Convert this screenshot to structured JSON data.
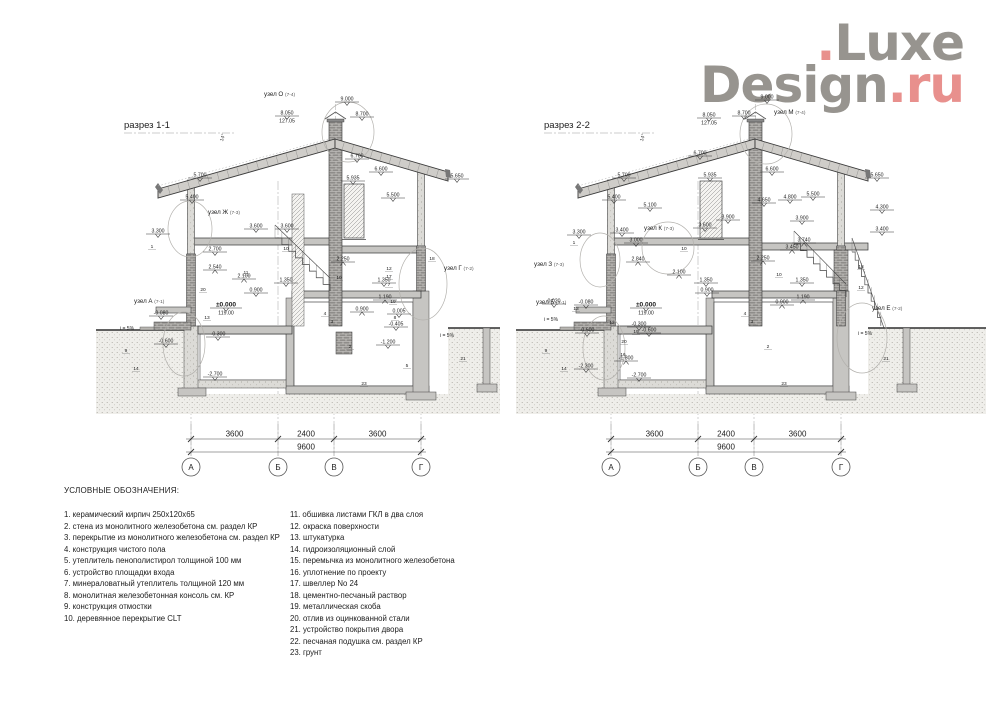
{
  "logo": {
    "top_dot": ".",
    "top_text": "Luxe",
    "bottom_text": "Design",
    "suffix": ".ru",
    "gray_color": "#97948f",
    "red_color": "#e8908d"
  },
  "legend": {
    "title": "УСЛОВНЫЕ ОБОЗНАЧЕНИЯ:",
    "col1": [
      "1. керамический кирпич 250x120x65",
      "2. стена из монолитного железобетона см. раздел КР",
      "3. перекрытие из монолитного железобетона см. раздел КР",
      "4. конструкция чистого пола",
      "5. утеплитель пенополистирол толщиной 100 мм",
      "6. устройство площадки входа",
      "7. минераловатный утеплитель толщиной 120 мм",
      "8. монолитная железобетонная консоль см. КР",
      "9. конструкция отмостки",
      "10. деревянное перекрытие CLT"
    ],
    "col2": [
      "11. обшивка листами ГКЛ в два слоя",
      "12. окраска поверхности",
      "13. штукатурка",
      "14. гидроизоляционный слой",
      "15. перемычка из монолитного железобетона",
      "16. уплотнение по проекту",
      "17. швеллер No 24",
      "18. цементно-песчаный раствор",
      "19. металлическая скоба",
      "20. отлив из оцинкованной стали",
      "21. устройство покрытия двора",
      "22. песчаная подушка см. раздел КР",
      "23. грунт"
    ]
  },
  "dimensions": {
    "segments": [
      "3600",
      "2400",
      "3600"
    ],
    "total": "9600",
    "axes": [
      "А",
      "Б",
      "В",
      "Г"
    ]
  },
  "sections": [
    {
      "id": "1-1",
      "title": "разрез 1-1",
      "angle": "14°",
      "nodes": [
        {
          "label": "узел О",
          "ref": "(7-4)",
          "x": 168,
          "y": 10,
          "cx": 252,
          "cy": 46,
          "rx": 26,
          "ry": 30
        },
        {
          "label": "узел Ж",
          "ref": "(7-3)",
          "x": 112,
          "y": 128,
          "cx": 94,
          "cy": 143,
          "rx": 22,
          "ry": 28
        },
        {
          "label": "узел Г",
          "ref": "(7-2)",
          "x": 348,
          "y": 184,
          "cx": 327,
          "cy": 198,
          "rx": 24,
          "ry": 36
        },
        {
          "label": "узел А",
          "ref": "(7-1)",
          "x": 38,
          "y": 217,
          "cx": 88,
          "cy": 258,
          "rx": 21,
          "ry": 32
        }
      ],
      "marks": [
        {
          "t": "9.000",
          "x": 251,
          "y": 16
        },
        {
          "t": "8.700",
          "x": 266,
          "y": 31
        },
        {
          "t": "8.050",
          "sub": "127.05",
          "x": 191,
          "y": 30
        },
        {
          "t": "6.700",
          "x": 261,
          "y": 73
        },
        {
          "t": "6.600",
          "x": 285,
          "y": 86
        },
        {
          "t": "5.935",
          "x": 257,
          "y": 95
        },
        {
          "t": "5.700",
          "x": 104,
          "y": 92
        },
        {
          "t": "5.400",
          "x": 96,
          "y": 114
        },
        {
          "t": "5.650",
          "x": 361,
          "y": 93
        },
        {
          "t": "5.500",
          "x": 297,
          "y": 112
        },
        {
          "t": "3.600",
          "x": 160,
          "y": 143
        },
        {
          "t": "3.600",
          "x": 191,
          "y": 143
        },
        {
          "t": "3.300",
          "x": 62,
          "y": 148
        },
        {
          "t": "2.700",
          "x": 119,
          "y": 166
        },
        {
          "t": "2.540",
          "x": 119,
          "y": 184,
          "up": 1
        },
        {
          "t": "2.250",
          "x": 247,
          "y": 176,
          "up": 1
        },
        {
          "t": "2.100",
          "x": 148,
          "y": 193,
          "up": 1
        },
        {
          "t": "1.350",
          "x": 190,
          "y": 197
        },
        {
          "t": "1.350",
          "x": 288,
          "y": 197
        },
        {
          "t": "1.190",
          "x": 289,
          "y": 214,
          "up": 1
        },
        {
          "t": "0.900",
          "x": 160,
          "y": 207
        },
        {
          "t": "0.900",
          "x": 266,
          "y": 226,
          "up": 1
        },
        {
          "t": "0.005",
          "x": 303,
          "y": 228
        },
        {
          "t": "-0.405",
          "x": 300,
          "y": 241
        },
        {
          "t": "-0.080",
          "x": 65,
          "y": 230
        },
        {
          "t": "-0.600",
          "x": 70,
          "y": 258
        },
        {
          "t": "-0.300",
          "x": 122,
          "y": 251
        },
        {
          "t": "-1.200",
          "x": 292,
          "y": 259
        },
        {
          "t": "-2.700",
          "x": 119,
          "y": 291
        },
        {
          "t": "±0.000",
          "sub": "119.00",
          "x": 130,
          "y": 222,
          "big": 1
        }
      ],
      "callouts": [
        {
          "t": "1",
          "x": 56,
          "y": 162
        },
        {
          "t": "20",
          "x": 107,
          "y": 205
        },
        {
          "t": "13",
          "x": 111,
          "y": 233
        },
        {
          "t": "9",
          "x": 30,
          "y": 266
        },
        {
          "t": "14",
          "x": 40,
          "y": 284
        },
        {
          "t": "10",
          "x": 190,
          "y": 164
        },
        {
          "t": "10",
          "x": 243,
          "y": 193
        },
        {
          "t": "11",
          "x": 150,
          "y": 188
        },
        {
          "t": "2",
          "x": 254,
          "y": 262
        },
        {
          "t": "4",
          "x": 229,
          "y": 229
        },
        {
          "t": "3",
          "x": 236,
          "y": 237
        },
        {
          "t": "12",
          "x": 293,
          "y": 184
        },
        {
          "t": "17",
          "x": 293,
          "y": 192
        },
        {
          "t": "7",
          "x": 293,
          "y": 200
        },
        {
          "t": "19",
          "x": 297,
          "y": 217
        },
        {
          "t": "8",
          "x": 299,
          "y": 233
        },
        {
          "t": "18",
          "x": 336,
          "y": 174
        },
        {
          "t": "21",
          "x": 367,
          "y": 274
        },
        {
          "t": "23",
          "x": 268,
          "y": 299
        },
        {
          "t": "5",
          "x": 311,
          "y": 281
        }
      ],
      "slopes": [
        {
          "t": "i = 5%",
          "x": 24,
          "y": 244
        },
        {
          "t": "i = 5%",
          "x": 344,
          "y": 251
        }
      ]
    },
    {
      "id": "2-2",
      "title": "разрез 2-2",
      "angle": "14°",
      "nodes": [
        {
          "label": "узел М",
          "ref": "(7-4)",
          "x": 258,
          "y": 28,
          "cx": 250,
          "cy": 48,
          "rx": 26,
          "ry": 30
        },
        {
          "label": "узел К",
          "ref": "(7-3)",
          "x": 128,
          "y": 144,
          "cx": 152,
          "cy": 162,
          "rx": 26,
          "ry": 26
        },
        {
          "label": "узел З",
          "ref": "(7-3)",
          "x": 18,
          "y": 180,
          "cx": 84,
          "cy": 174,
          "rx": 20,
          "ry": 27
        },
        {
          "label": "узел Б",
          "ref": "(7-1)",
          "x": 20,
          "y": 218,
          "cx": 88,
          "cy": 262,
          "rx": 21,
          "ry": 32
        },
        {
          "label": "узел Е",
          "ref": "(7-2)",
          "x": 356,
          "y": 224,
          "cx": 346,
          "cy": 252,
          "rx": 25,
          "ry": 35
        }
      ],
      "marks": [
        {
          "t": "9.000",
          "x": 251,
          "y": 14
        },
        {
          "t": "8.700",
          "x": 228,
          "y": 30
        },
        {
          "t": "8.050",
          "sub": "127.05",
          "x": 193,
          "y": 32
        },
        {
          "t": "6.700",
          "x": 184,
          "y": 70
        },
        {
          "t": "6.600",
          "x": 256,
          "y": 86
        },
        {
          "t": "5.935",
          "x": 194,
          "y": 92
        },
        {
          "t": "5.700",
          "x": 108,
          "y": 92
        },
        {
          "t": "5.400",
          "x": 98,
          "y": 114
        },
        {
          "t": "5.100",
          "x": 134,
          "y": 122
        },
        {
          "t": "5.650",
          "x": 361,
          "y": 92
        },
        {
          "t": "5.500",
          "x": 297,
          "y": 111
        },
        {
          "t": "4.800",
          "x": 274,
          "y": 114
        },
        {
          "t": "4.650",
          "x": 248,
          "y": 117
        },
        {
          "t": "4.300",
          "x": 366,
          "y": 124
        },
        {
          "t": "3.900",
          "x": 212,
          "y": 134
        },
        {
          "t": "3.900",
          "x": 286,
          "y": 135
        },
        {
          "t": "3.740",
          "x": 288,
          "y": 157,
          "up": 1
        },
        {
          "t": "3.450",
          "x": 276,
          "y": 164,
          "up": 1
        },
        {
          "t": "3.600",
          "x": 189,
          "y": 142
        },
        {
          "t": "3.400",
          "x": 106,
          "y": 147
        },
        {
          "t": "3.400",
          "x": 366,
          "y": 146
        },
        {
          "t": "3.300",
          "x": 63,
          "y": 149
        },
        {
          "t": "3.000",
          "x": 120,
          "y": 157
        },
        {
          "t": "2.840",
          "x": 122,
          "y": 176,
          "up": 1
        },
        {
          "t": "2.250",
          "x": 247,
          "y": 175,
          "up": 1
        },
        {
          "t": "2.100",
          "x": 163,
          "y": 189,
          "up": 1
        },
        {
          "t": "1.350",
          "x": 190,
          "y": 197
        },
        {
          "t": "1.350",
          "x": 286,
          "y": 197
        },
        {
          "t": "1.190",
          "x": 287,
          "y": 214,
          "up": 1
        },
        {
          "t": "0.900",
          "x": 191,
          "y": 207
        },
        {
          "t": "0.900",
          "x": 266,
          "y": 219,
          "up": 1
        },
        {
          "t": "0.020",
          "x": 38,
          "y": 218
        },
        {
          "t": "-0.080",
          "x": 70,
          "y": 219
        },
        {
          "t": "-0.300",
          "x": 123,
          "y": 241
        },
        {
          "t": "-0.600",
          "x": 71,
          "y": 247
        },
        {
          "t": "-0.600",
          "x": 133,
          "y": 247
        },
        {
          "t": "-1.800",
          "x": 110,
          "y": 275,
          "up": 1
        },
        {
          "t": "-2.300",
          "x": 70,
          "y": 283
        },
        {
          "t": "-2.700",
          "x": 123,
          "y": 292
        },
        {
          "t": "±0.000",
          "sub": "119.00",
          "x": 130,
          "y": 222,
          "big": 1
        }
      ],
      "callouts": [
        {
          "t": "1",
          "x": 58,
          "y": 158
        },
        {
          "t": "12",
          "x": 96,
          "y": 238
        },
        {
          "t": "10",
          "x": 168,
          "y": 164
        },
        {
          "t": "10",
          "x": 263,
          "y": 190
        },
        {
          "t": "13",
          "x": 60,
          "y": 224
        },
        {
          "t": "20",
          "x": 108,
          "y": 257
        },
        {
          "t": "16",
          "x": 107,
          "y": 270
        },
        {
          "t": "19",
          "x": 120,
          "y": 247
        },
        {
          "t": "2",
          "x": 252,
          "y": 262
        },
        {
          "t": "4",
          "x": 229,
          "y": 229
        },
        {
          "t": "3",
          "x": 236,
          "y": 237
        },
        {
          "t": "18",
          "x": 345,
          "y": 182
        },
        {
          "t": "12",
          "x": 345,
          "y": 203
        },
        {
          "t": "14",
          "x": 48,
          "y": 284
        },
        {
          "t": "9",
          "x": 30,
          "y": 266
        },
        {
          "t": "21",
          "x": 370,
          "y": 274
        },
        {
          "t": "23",
          "x": 268,
          "y": 299
        }
      ],
      "slopes": [
        {
          "t": "i = 5%",
          "x": 28,
          "y": 235
        },
        {
          "t": "i = 5%",
          "x": 342,
          "y": 249
        }
      ]
    }
  ]
}
